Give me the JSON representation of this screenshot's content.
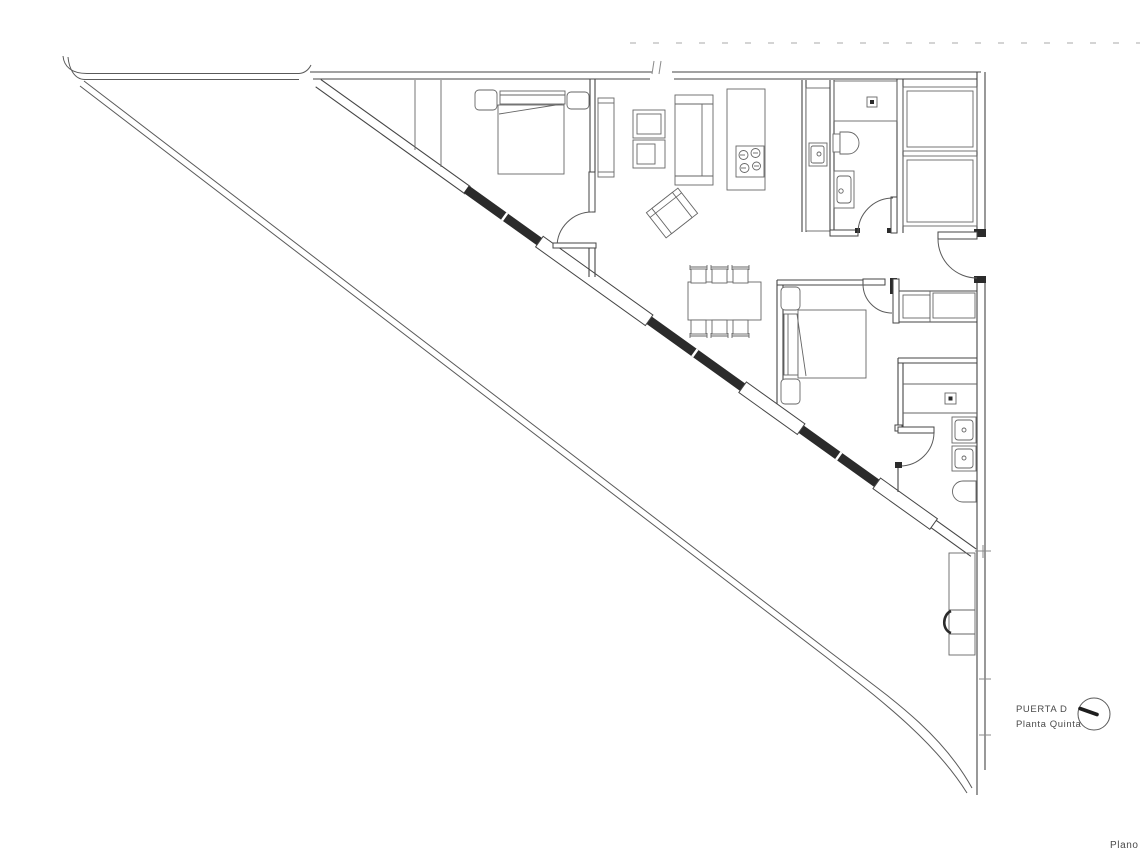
{
  "annotation": {
    "door_label": "PUERTA D",
    "floor_label": "Planta Quinta",
    "corner_label": "Plano",
    "dial_icon": "orientation-dial-icon"
  },
  "drawing": {
    "type": "architectural-floor-plan",
    "colors": {
      "background": "#ffffff",
      "line": "#5a5a5a",
      "wall": "#454545",
      "window_fill": "#2b2b2b",
      "faint": "#c6c6c6",
      "text": "#4a4a4a"
    },
    "elements": [
      "terrace-parapet",
      "glazed-facade",
      "top-wall",
      "right-wall",
      "entry-door",
      "bedroom-1",
      "bedroom-1-bed",
      "bedroom-1-closet",
      "wardrobe",
      "tv-unit",
      "sofa",
      "armchair",
      "kitchen-island",
      "cooktop",
      "kitchen-counter",
      "kitchen-sink",
      "bathroom-1",
      "shower-1",
      "toilet-1",
      "washbasin-1",
      "dining-table",
      "dining-chairs",
      "bedroom-2",
      "bedroom-2-bed",
      "laundry-closet",
      "bathroom-2",
      "shower-2",
      "washbasin-2a",
      "washbasin-2b",
      "toilet-2",
      "service-shafts",
      "terrace-unit"
    ]
  }
}
